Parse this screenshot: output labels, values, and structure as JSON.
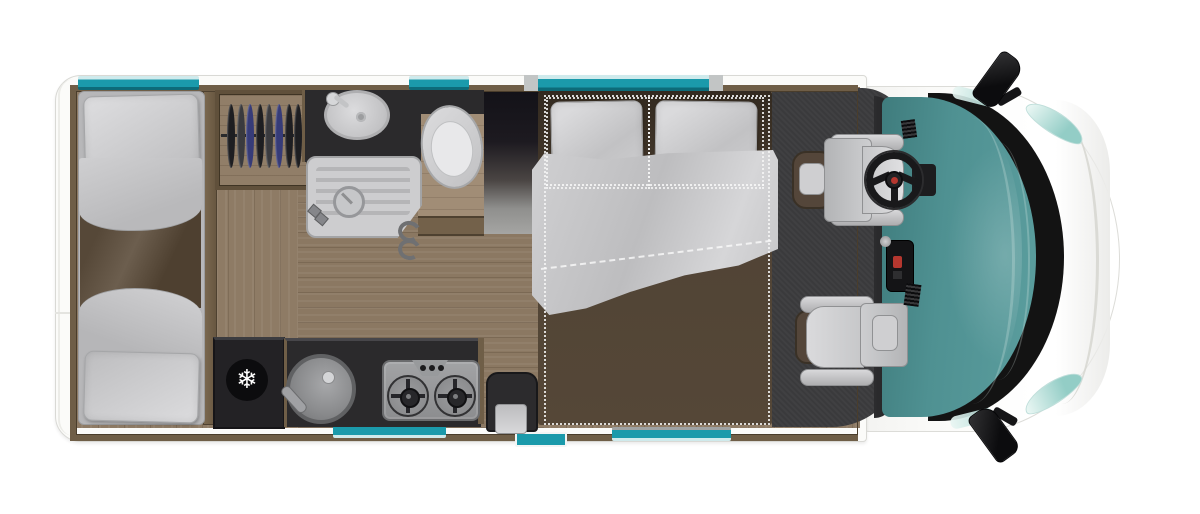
{
  "meta": {
    "description": "Top-down floor plan of a motorhome with rear twin beds, wardrobe, bathroom, kitchen, double bed and cab with two swivel seats"
  },
  "palette": {
    "teal": "#1b9aab",
    "glass_light": "#cfeaec",
    "windshield": "#4f9192",
    "windshield_dark": "#3f7c7d",
    "crescent": "#131313",
    "body_white": "#fbfbf9",
    "wall_wood": "#6f5e47",
    "floor_wood": "#8e7b65",
    "floor_wood_mid": "#8b7862",
    "counter_dark": "#2b2a2c",
    "appliance_dark": "#232225",
    "carpet": "#3a3a3c",
    "mattress_brown": "#554737",
    "hanger_dark": "#1e1e21",
    "hanger_blue": "#363b78",
    "accent_red": "#b5372f"
  },
  "icons": {
    "fridge_snowflake": "❄"
  },
  "wardrobe": {
    "hangers": [
      "dark",
      "gray",
      "blue",
      "dark",
      "gray",
      "blue",
      "dark",
      "dark"
    ]
  },
  "kitchen": {
    "burner_count": 2
  },
  "windows": {
    "top": [
      {
        "x": 78,
        "y": 76,
        "w": 121,
        "h": 14,
        "caps": false
      },
      {
        "x": 409,
        "y": 76,
        "w": 60,
        "h": 14,
        "caps": false
      },
      {
        "x": 524,
        "y": 75,
        "w": 199,
        "h": 16,
        "caps": true
      }
    ],
    "bottom": [
      {
        "x": 333,
        "y": 424,
        "w": 113,
        "h": 14
      },
      {
        "x": 612,
        "y": 427,
        "w": 119,
        "h": 14
      }
    ],
    "door": [
      {
        "x": 515,
        "y": 432,
        "w": 48,
        "h": 11
      }
    ]
  }
}
